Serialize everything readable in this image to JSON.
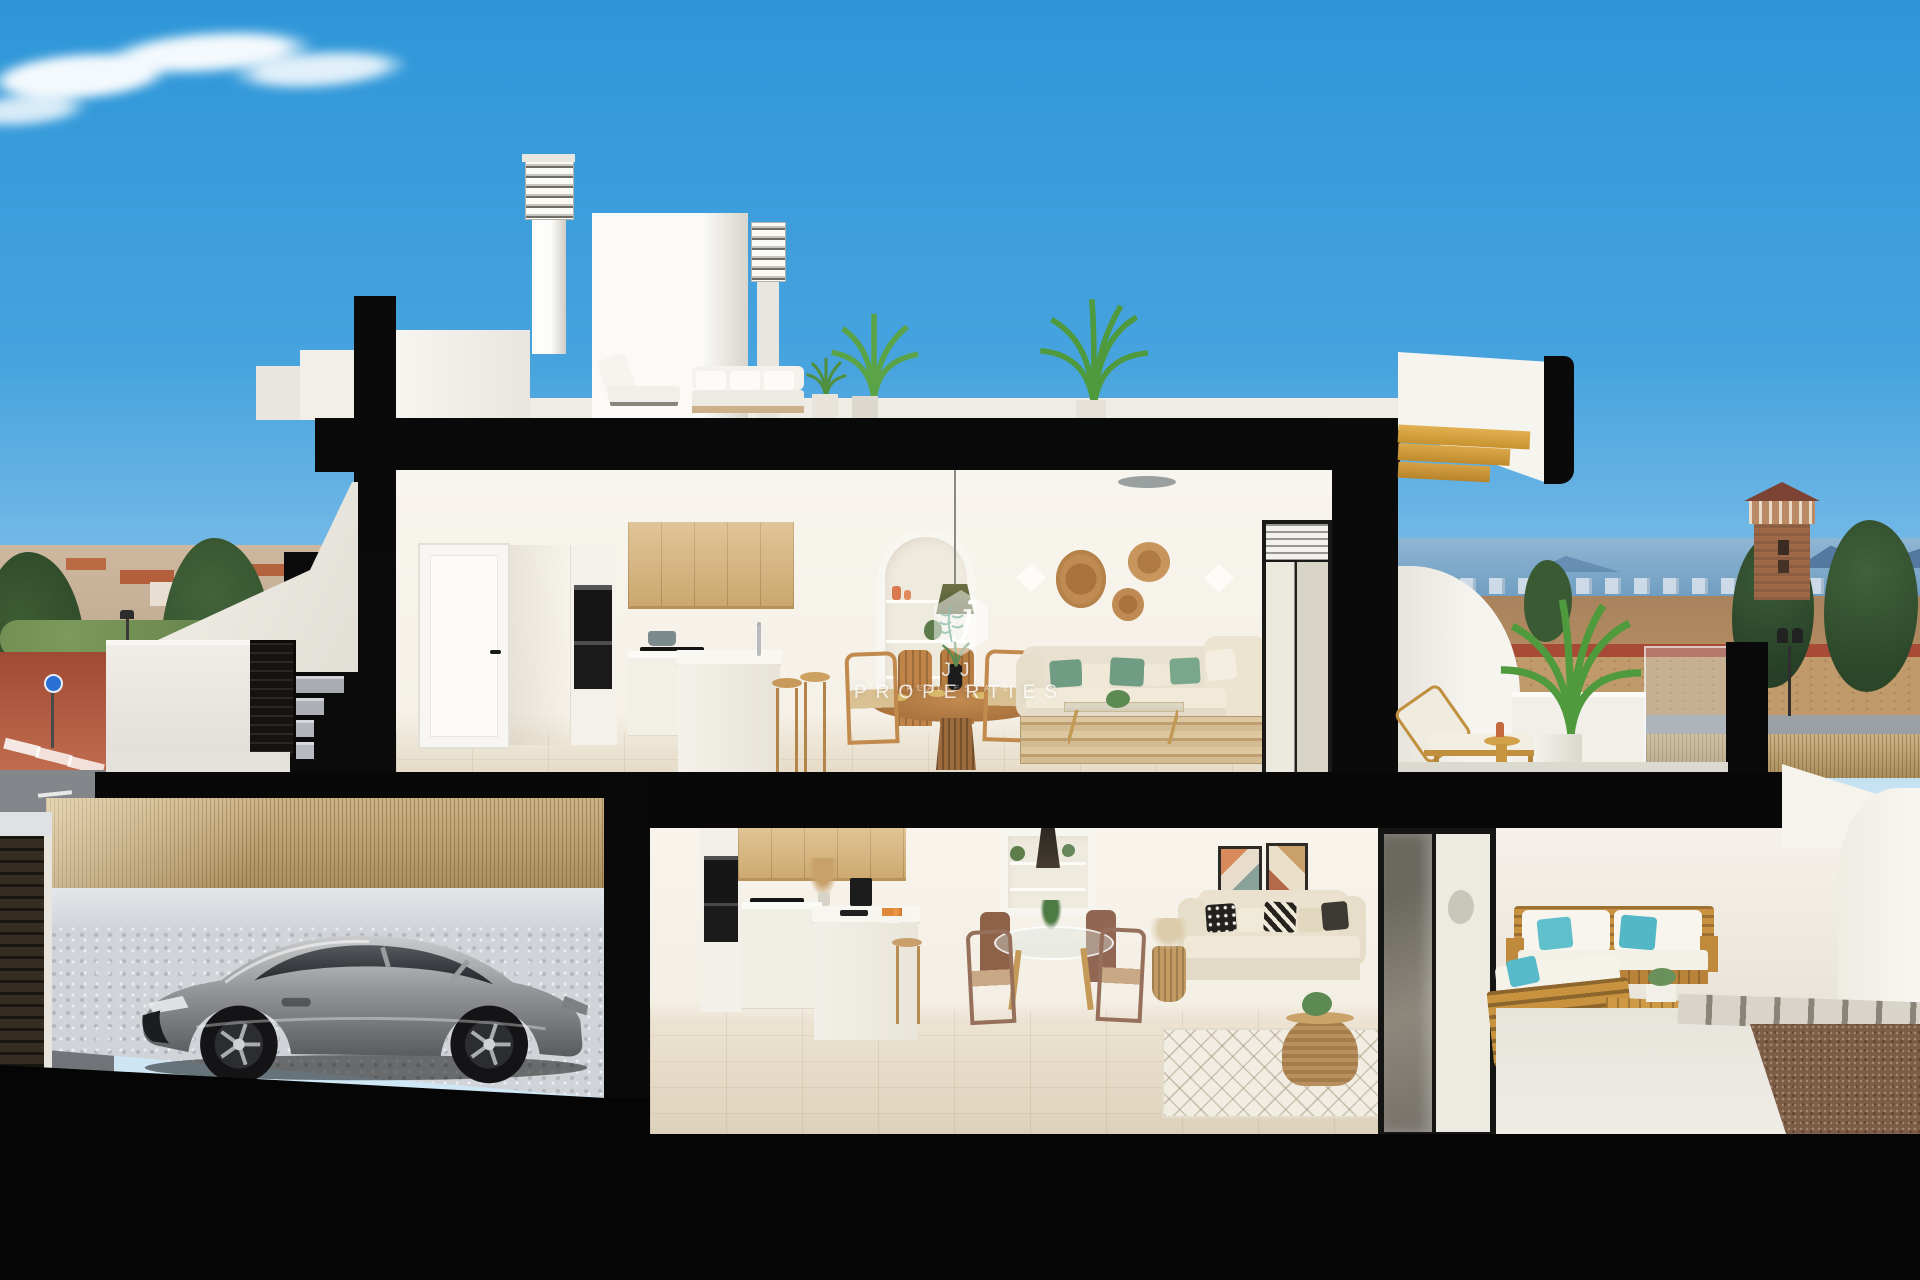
{
  "watermark": {
    "monogram": "j",
    "title": "JJ PROPERTIES",
    "subtitle": "REAL ESTATE"
  },
  "palette": {
    "sky_top": "#2e96d8",
    "sky_horizon": "#c9e3f3",
    "cut_black": "#070707",
    "wall_white": "#f5f2ec",
    "oak_cabinet": "#d7b276",
    "outdoor_wood": "#c8913f",
    "sofa_cream": "#e7dfcc",
    "pillow_green": "#6f9c82",
    "pillow_teal": "#5bbcc8",
    "floor_tile": "#e0d6c3",
    "car_silver": "#9a9c9f",
    "reed_fence": "#c2a169",
    "street_red": "#a54e39",
    "sea_blue": "#7fa9c9",
    "tower_brick": "#9c6848",
    "tree_green": "#2e4a30",
    "stair_wood": "#d9a33c"
  }
}
